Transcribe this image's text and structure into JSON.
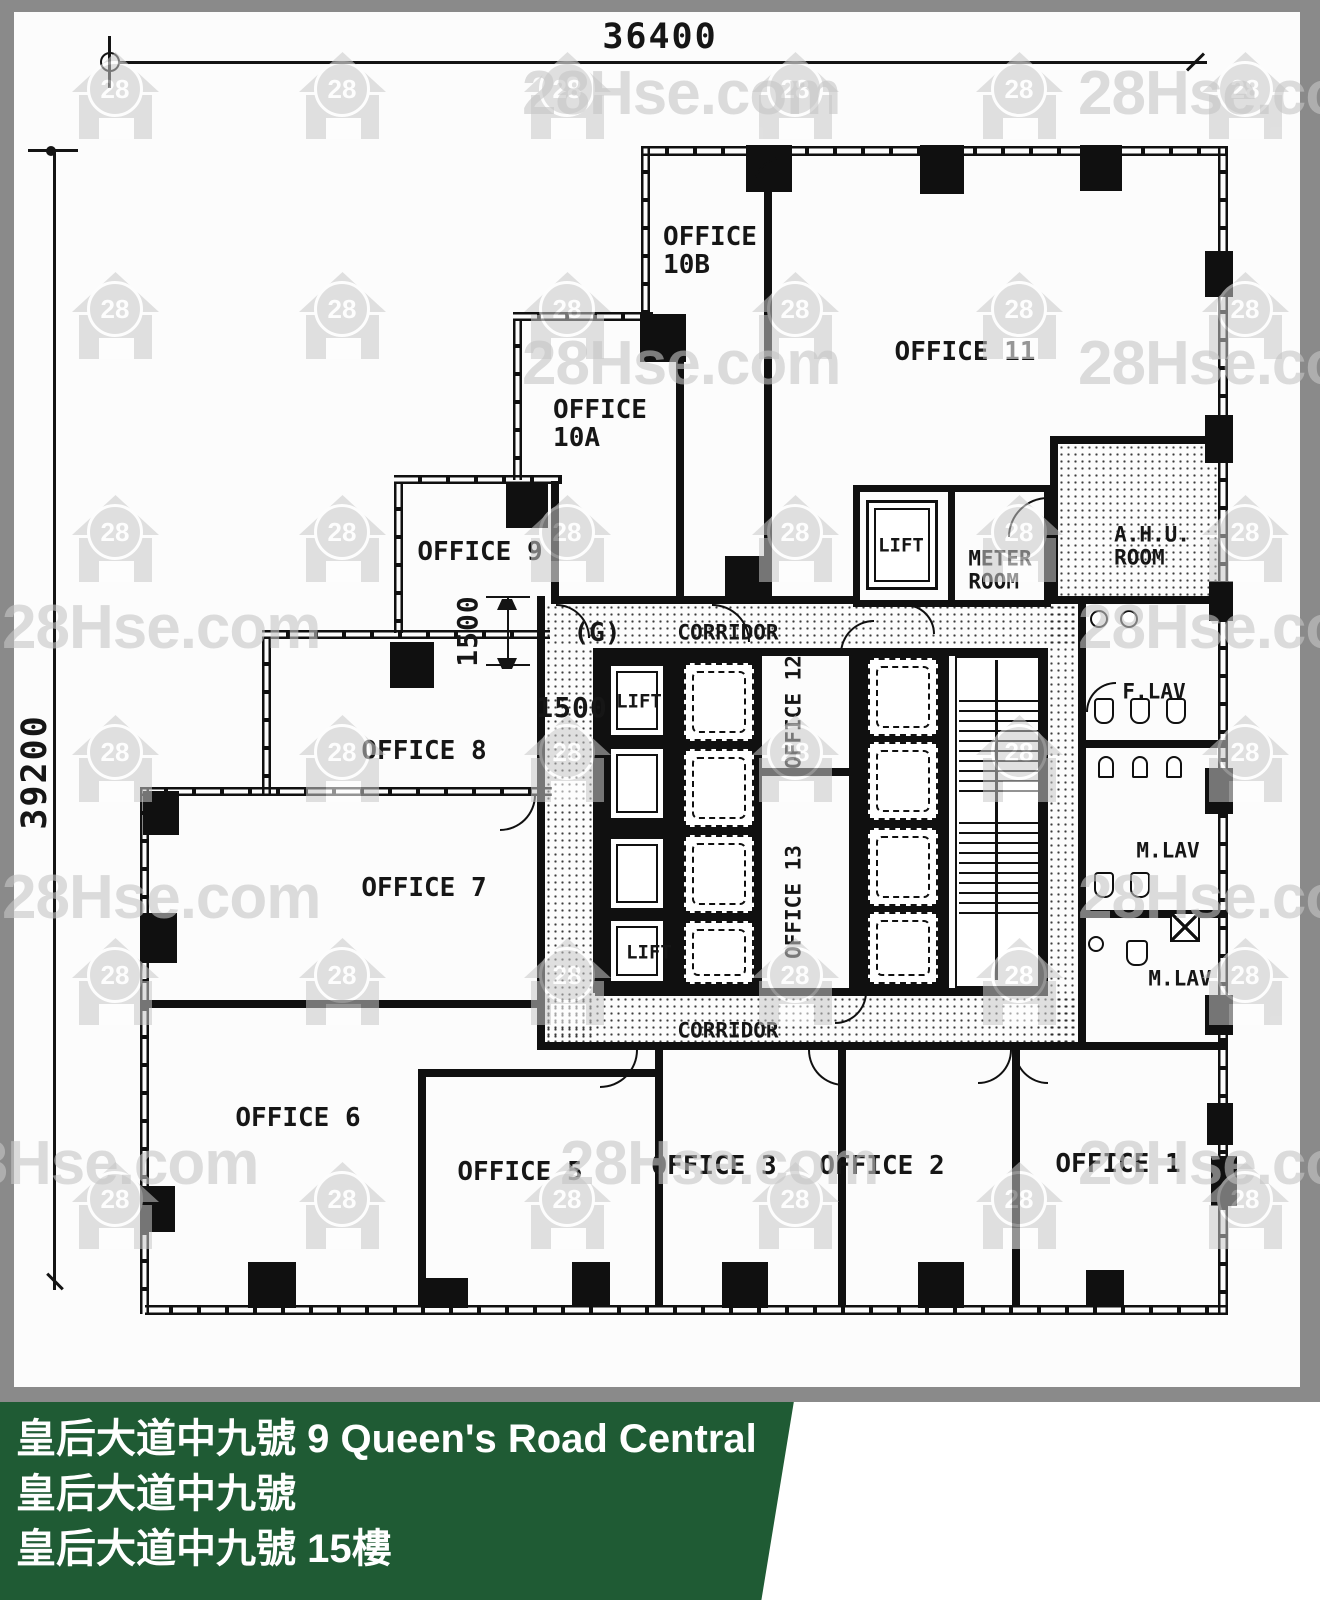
{
  "watermark": {
    "text": "28Hse.com",
    "icon_text": "28"
  },
  "dimensions": {
    "top": "36400",
    "left": "39200",
    "office9_vertical": "1500",
    "lobby": "1500"
  },
  "rooms": {
    "office1": "OFFICE 1",
    "office2": "OFFICE 2",
    "office3": "OFFICE 3",
    "office5": "OFFICE 5",
    "office6": "OFFICE 6",
    "office7": "OFFICE 7",
    "office8": "OFFICE 8",
    "office9": "OFFICE 9",
    "office10a": "OFFICE\n10A",
    "office10b": "OFFICE\n10B",
    "office11": "OFFICE 11",
    "office12": "OFFICE 12",
    "office13": "OFFICE 13",
    "ahu_room": "A.H.U.\nROOM",
    "meter_room": "METER\nROOM",
    "lift_top": "LIFT",
    "lift_upper": "LIFT",
    "lift_lower": "LIFT",
    "g_label": "(G)",
    "corridor_top": "CORRIDOR",
    "corridor_bottom": "CORRIDOR",
    "f_lav": "F.LAV",
    "m_lav_1": "M.LAV",
    "m_lav_2": "M.LAV"
  },
  "banner": {
    "line1": "皇后大道中九號 9 Queen's Road Central",
    "line2": "皇后大道中九號",
    "line3": "皇后大道中九號 15樓",
    "bg_color": "#1f5b34",
    "text_color": "#ffffff"
  },
  "logo": {
    "brand": "28Hse.com",
    "badge": "28",
    "tagline": "香港屋網",
    "green": "#1c8a3e",
    "red": "#e2171f"
  }
}
